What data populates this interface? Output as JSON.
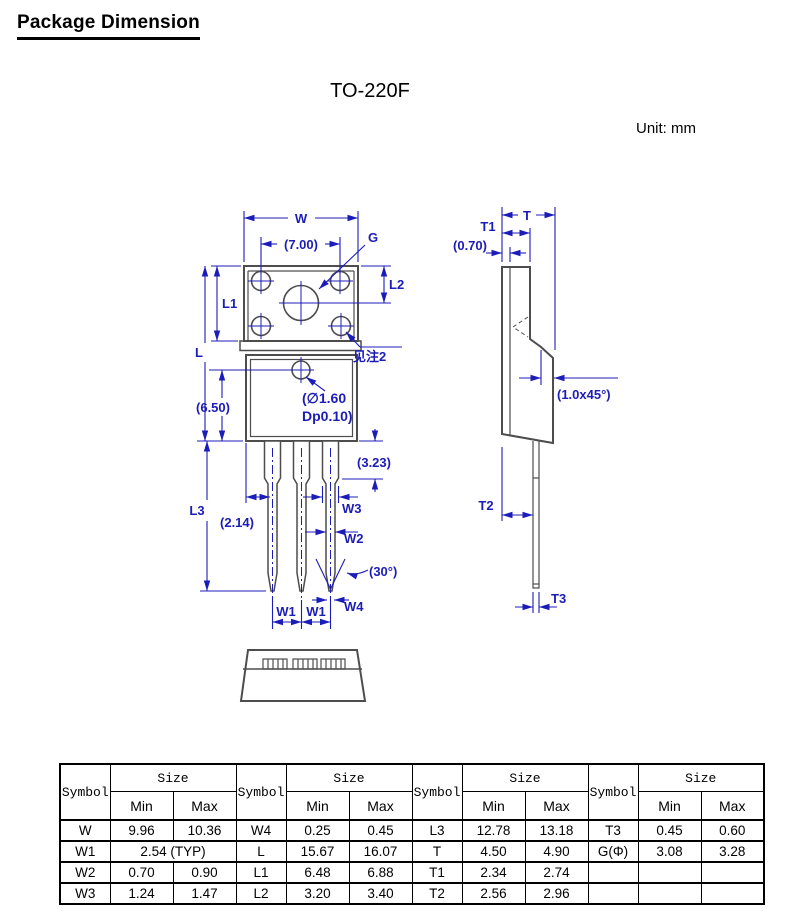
{
  "page": {
    "title": "Package Dimension",
    "package_name": "TO-220F",
    "unit_label": "Unit: mm"
  },
  "colors": {
    "dimension_blue": "#1c1cb8",
    "outline_gray": "#4d4d4d",
    "table_border": "#000000"
  },
  "drawing": {
    "front_view": {
      "labels": {
        "w": "W",
        "d7_00": "(7.00)",
        "g": "G",
        "l2": "L2",
        "l1": "L1",
        "l": "L",
        "note2": "见注2",
        "hole_line1": "(∅1.60",
        "hole_line2": "Dp0.10)",
        "d6_50": "(6.50)",
        "d3_23": "(3.23)",
        "w3": "W3",
        "d2_14": "(2.14)",
        "w2": "W2",
        "d30": "(30°)",
        "l3": "L3",
        "w1_left": "W1",
        "w1_right": "W1",
        "w4": "W4"
      }
    },
    "side_view": {
      "labels": {
        "t": "T",
        "t1": "T1",
        "d0_70": "(0.70)",
        "chamfer": "(1.0x45°)",
        "t2": "T2",
        "t3": "T3"
      }
    }
  },
  "table": {
    "headers": {
      "symbol": "Symbol",
      "size": "Size",
      "min": "Min",
      "max": "Max"
    },
    "groups": [
      {
        "rows": [
          {
            "symbol": "W",
            "min": "9.96",
            "max": "10.36"
          },
          {
            "symbol": "W1",
            "size": "2.54 (TYP)"
          },
          {
            "symbol": "W2",
            "min": "0.70",
            "max": "0.90"
          },
          {
            "symbol": "W3",
            "min": "1.24",
            "max": "1.47"
          }
        ]
      },
      {
        "rows": [
          {
            "symbol": "W4",
            "min": "0.25",
            "max": "0.45"
          },
          {
            "symbol": "L",
            "min": "15.67",
            "max": "16.07"
          },
          {
            "symbol": "L1",
            "min": "6.48",
            "max": "6.88"
          },
          {
            "symbol": "L2",
            "min": "3.20",
            "max": "3.40"
          }
        ]
      },
      {
        "rows": [
          {
            "symbol": "L3",
            "min": "12.78",
            "max": "13.18"
          },
          {
            "symbol": "T",
            "min": "4.50",
            "max": "4.90"
          },
          {
            "symbol": "T1",
            "min": "2.34",
            "max": "2.74"
          },
          {
            "symbol": "T2",
            "min": "2.56",
            "max": "2.96"
          }
        ]
      },
      {
        "rows": [
          {
            "symbol": "T3",
            "min": "0.45",
            "max": "0.60"
          },
          {
            "symbol": "G(Φ)",
            "min": "3.08",
            "max": "3.28"
          },
          {
            "symbol": "",
            "min": "",
            "max": ""
          },
          {
            "symbol": "",
            "min": "",
            "max": ""
          }
        ]
      }
    ]
  }
}
